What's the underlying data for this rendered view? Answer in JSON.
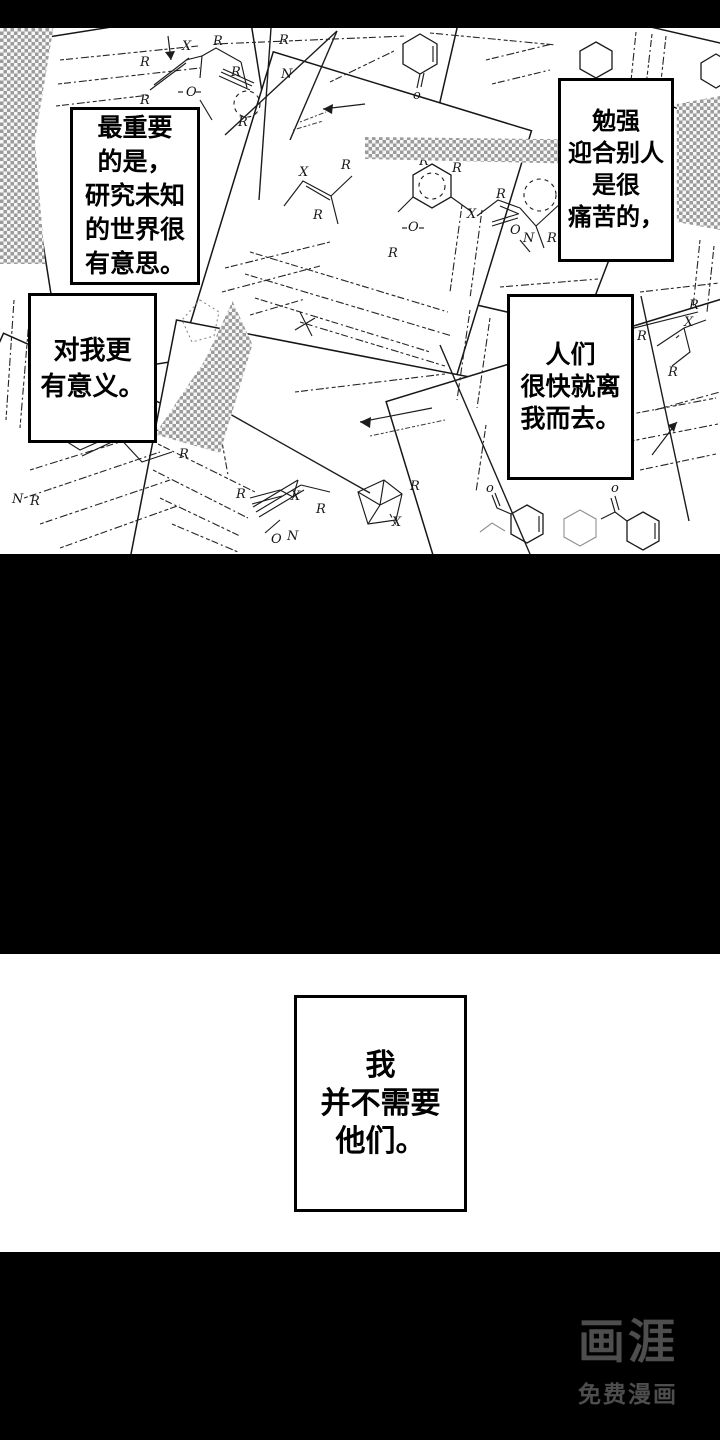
{
  "bubbles": [
    {
      "lines": [
        "最重要",
        "的是，",
        "研究未知",
        "的世界很",
        "有意思。"
      ]
    },
    {
      "lines": [
        "对我更",
        "有意义。"
      ]
    },
    {
      "lines": [
        "勉强",
        "迎合别人",
        "是很",
        "痛苦的，"
      ]
    },
    {
      "lines": [
        "人们",
        "很快就离",
        "我而去。"
      ]
    },
    {
      "lines": [
        "我",
        "并不需要",
        "他们。"
      ]
    }
  ],
  "watermark": {
    "logo": "画涯",
    "tagline": "免费漫画"
  },
  "colors": {
    "halftone": "#9b9b9b",
    "watermark_gray": "#4e4e4e",
    "ink": "#161616",
    "paper": "#ffffff"
  },
  "artwork": {
    "description": "scattered chemistry manuscript pages",
    "labels": [
      "R",
      "X",
      "R",
      "R",
      "O",
      "R",
      "R",
      "R",
      "N",
      "X",
      "R",
      "R",
      "R",
      "R",
      "X",
      "R",
      "R",
      "R",
      "X",
      "R",
      "R",
      "N",
      "N",
      "R",
      "R",
      "X",
      "R",
      "X",
      "o",
      "o",
      "o",
      "R",
      "X",
      "R",
      "O",
      "O",
      "O",
      "N",
      "R"
    ]
  }
}
